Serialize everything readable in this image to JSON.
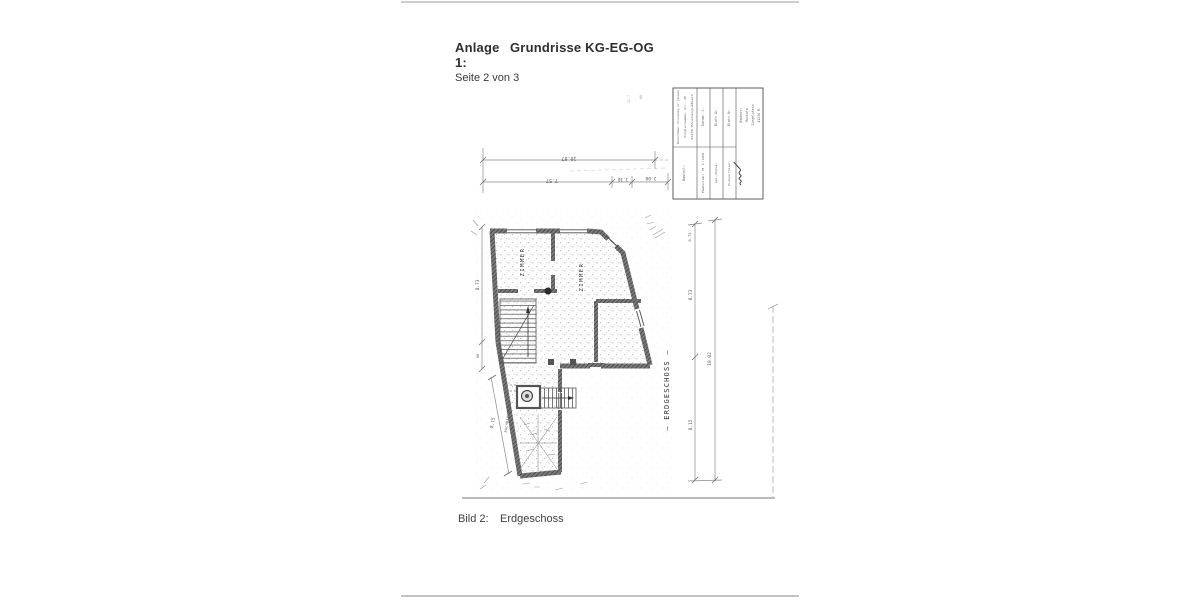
{
  "page": {
    "header": {
      "anlage_label": "Anlage 1:",
      "title": "Grundrisse KG-EG-OG",
      "subtitle": "Seite 2 von 3"
    },
    "caption": {
      "label": "Bild 2:",
      "text": "Erdgeschoss"
    }
  },
  "drawing": {
    "floor_label": "— ERDGESCHOSS —",
    "rooms": {
      "room1": "ZIMMER",
      "room2": "ZIMMER"
    },
    "wall_note": "NACHBAR ANBAU",
    "dimensions": {
      "top_total": "10.87",
      "top_a": "7.57",
      "top_b": "1.30",
      "top_c": "2.00",
      "left_height": "8.73",
      "left_small": "50",
      "left_lower": "8.15",
      "right_upper": "8.73",
      "right_lower": "8.15",
      "right_total": "18.02",
      "right_top_small": "0.72"
    },
    "annotations": {
      "level_a": "41.7",
      "level_b": "NN"
    },
    "title_block": {
      "project_line1": "Bauvorhaben: Verwendung der Fassade",
      "project_line2": "Zieglernummer Str. 40",
      "project_line3": "41236 Mönchengladbach",
      "col2_top": "Datum: 1.",
      "col3_top": "Blatt Gr.",
      "col4_top": "Blatt Nr.",
      "col1_bottom": "Bauteil:",
      "col2_bottom": "Maßstab: M 1:100",
      "col3_bottom": "gez./Datum:",
      "col4_bottom": "Planverfasser:",
      "owner_line1": "Bauherr:",
      "owner_line2": "Mustafa",
      "owner_line3": "Ziegelstein",
      "owner_line4": "41236 M."
    }
  },
  "colors": {
    "ink": "#3a3a3a",
    "dim": "#8a8a8a",
    "paper": "#ffffff",
    "edge": "#c8c8c8"
  }
}
